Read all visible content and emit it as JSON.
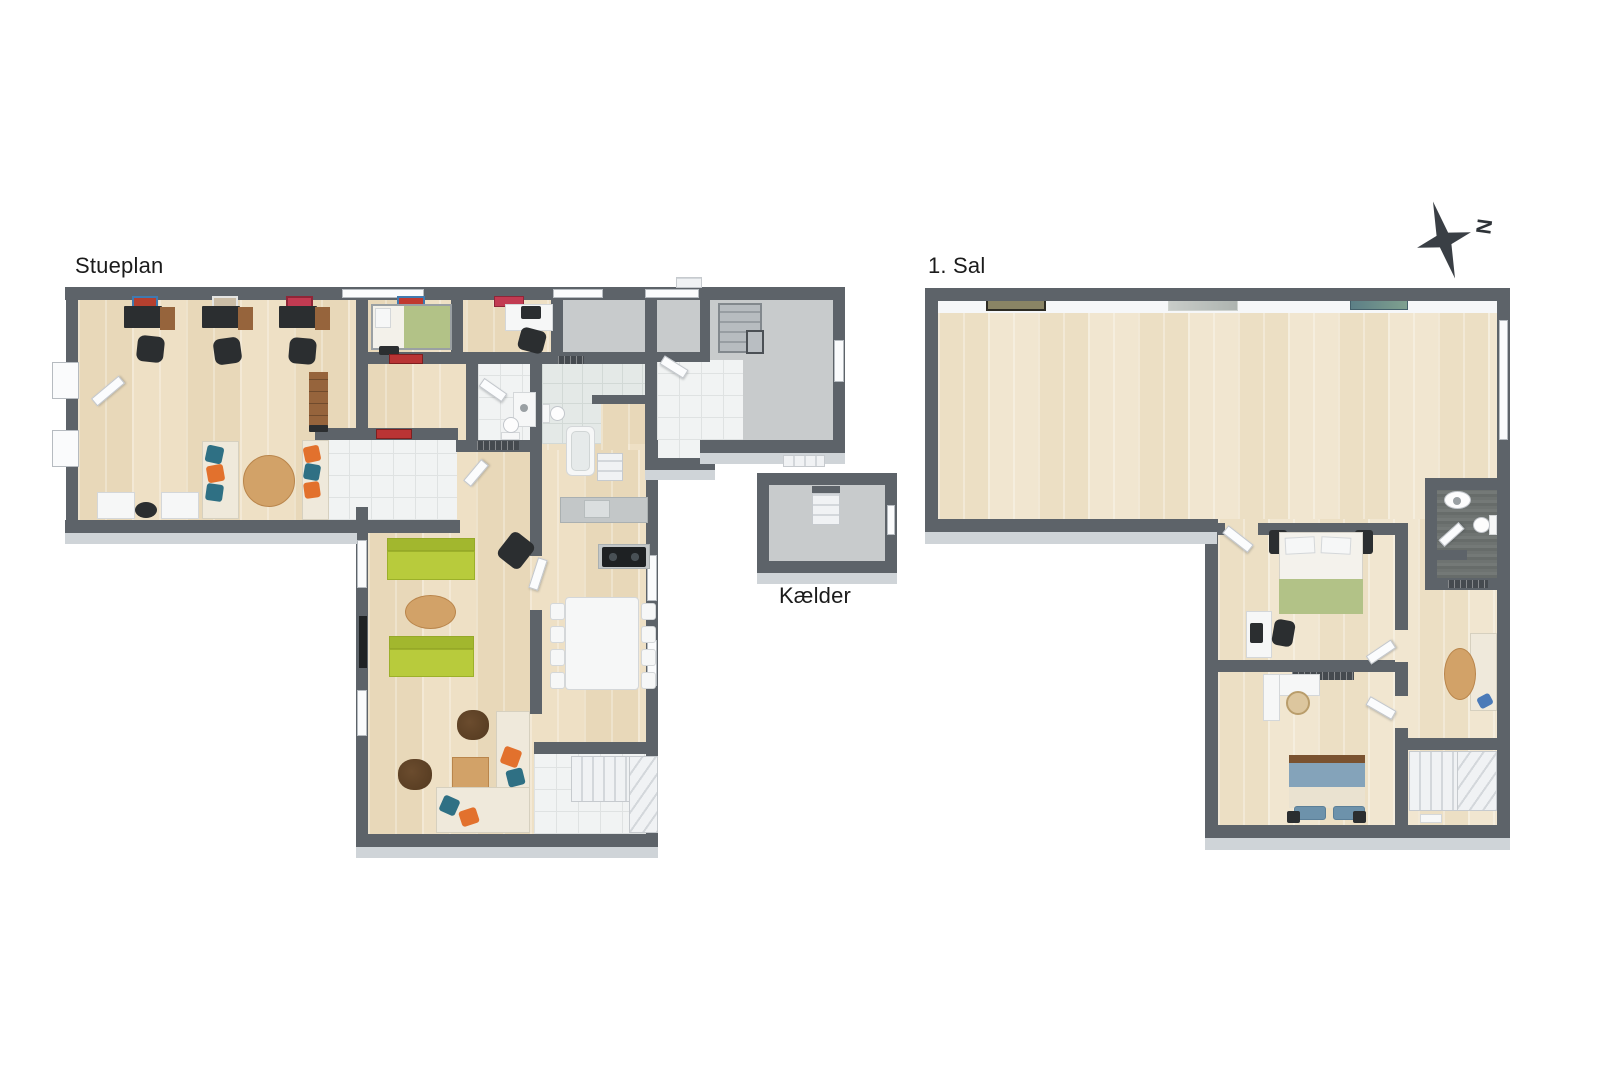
{
  "plans": {
    "ground_floor": {
      "label": "Stueplan"
    },
    "first_floor": {
      "label": "1. Sal"
    },
    "basement": {
      "label": "Kælder"
    }
  },
  "compass": {
    "north_label": "N"
  },
  "colors": {
    "wall": "#5d6369",
    "concrete": "#c8cbcc",
    "wood_floor": "#e9dabd",
    "wood_floor_light": "#eee3cb",
    "tile_white": "#f1f3f3",
    "tile_pale": "#e4e9e7",
    "dark_tile": "#6f7472",
    "lime_sofa": "#b8cb3c",
    "orange_accent": "#e2712d",
    "teal_accent": "#2f7084",
    "cream_sofa": "#efe9db",
    "wood_furniture": "#96643c",
    "wood_table": "#d2a268",
    "black_furniture": "#2b2e30",
    "green_bedding": "#b2c287",
    "blue_bedding": "#84a3ba",
    "red_rug": "#b93434",
    "background": "#ffffff"
  }
}
